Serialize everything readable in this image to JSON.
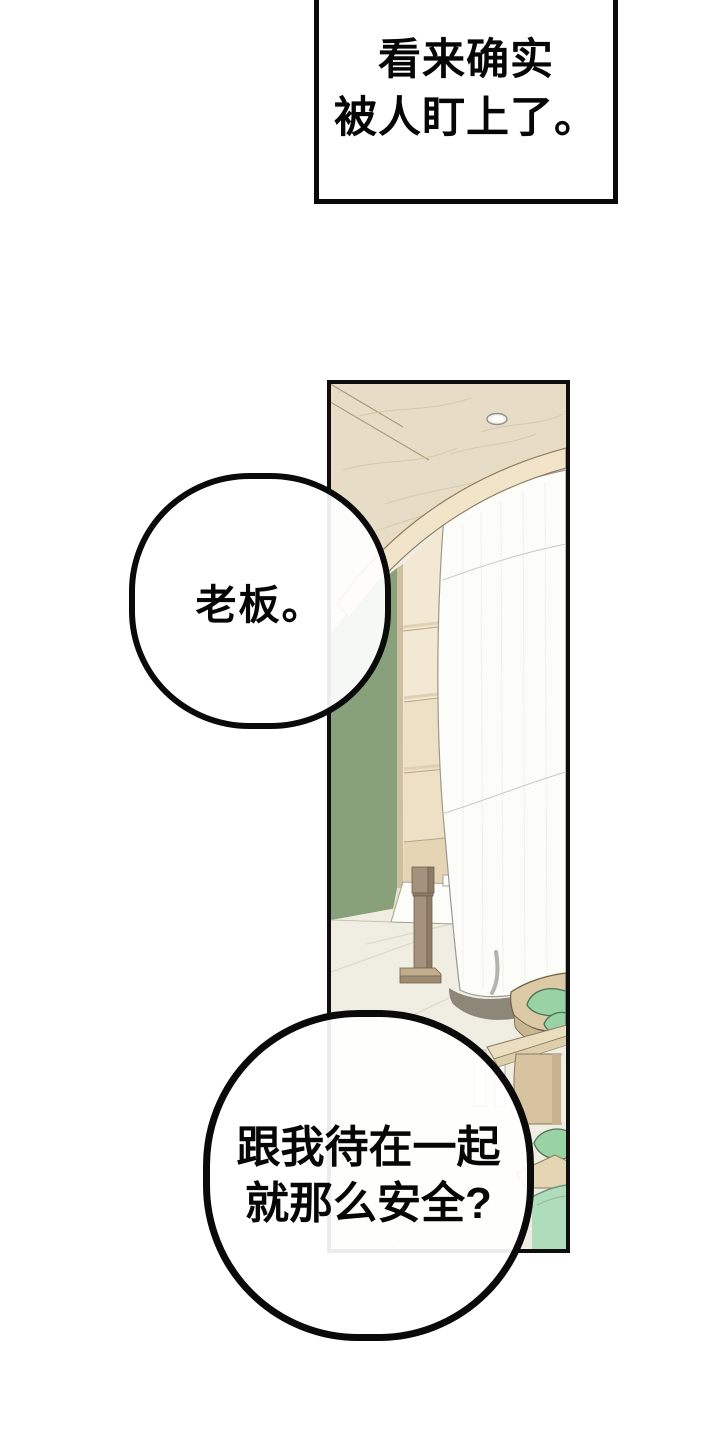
{
  "page": {
    "width": 720,
    "height": 1440,
    "background": "#ffffff"
  },
  "narration_box": {
    "line1": "看来确实",
    "line2": "被人盯上了。",
    "border_color": "#0a0a0a",
    "background": "#ffffff"
  },
  "bubbles": {
    "boss": {
      "text": "老板。"
    },
    "question": {
      "line1": "跟我待在一起",
      "line2": "就那么安全?"
    }
  },
  "panel": {
    "border_color": "#0e0e0e",
    "colors": {
      "ceiling_wood": "#e7dcc5",
      "ceiling_rim": "#f1e4c9",
      "green_wall": "#89a17a",
      "wall_trim": "#cdbf9f",
      "shelf_wood": "#f2e8d4",
      "lower_wall": "#ece0c6",
      "floor": "#f0ede3",
      "tablecloth": "#fcfcf9",
      "sign_white": "#fbfbf8",
      "post_front": "#a5917d",
      "post_side": "#8d7a67",
      "post_base": "#c2ae8f",
      "white_column": "#fcfcf9",
      "column_shadow": "#8d877a",
      "table_wood": "#dcc9a6",
      "table_side": "#c9b692",
      "bench_wood": "#ebdec0",
      "pedestal_wood": "#d7c39f",
      "cushion_green": "#99d2a4",
      "low_wood": "#e4d5b3",
      "floor_mat": "#afdcba",
      "light_ring": "#90908a"
    }
  }
}
